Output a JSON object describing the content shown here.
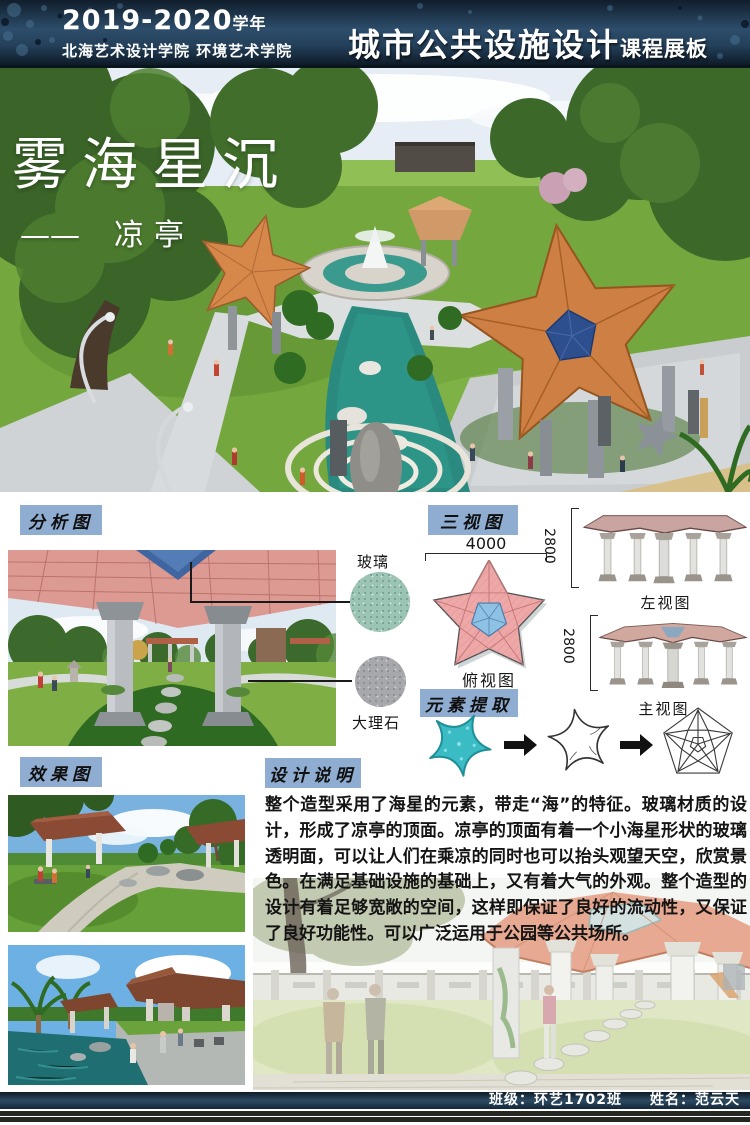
{
  "header": {
    "year": "2019-2020",
    "year_suffix": "学年",
    "school": "北海艺术设计学院 环境艺术学院",
    "title_main": "城市公共设施设计",
    "title_sub": "课程展板"
  },
  "hero": {
    "title": "雾海星沉",
    "dash": "——",
    "subtitle": "凉亭"
  },
  "labels": {
    "analysis": "分析图",
    "three_view": "三视图",
    "element_extract": "元素提取",
    "effect": "效果图",
    "description": "设计说明"
  },
  "materials": {
    "glass": "玻璃",
    "marble": "大理石"
  },
  "three_view": {
    "width_dim": "4000",
    "left_dim": "2800",
    "front_dim": "2800",
    "top_label": "俯视图",
    "left_label": "左视图",
    "front_label": "主视图"
  },
  "description_text": "整个造型采用了海星的元素，带走“海”的特征。玻璃材质的设计，形成了凉亭的顶面。凉亭的顶面有着一个小海星形状的玻璃透明面，可以让人们在乘凉的同时也可以抬头观望天空，欣赏景色。在满足基础设施的基础上，又有着大气的外观。整个造型的设计有着足够宽敞的空间，这样即保证了良好的流动性，又保证了良好功能性。可以广泛运用于公园等公共场所。",
  "footer": {
    "class_field": "班级：环艺1702班",
    "name_field": "姓名：范云天"
  },
  "accent_colors": {
    "header_navy": "#223c54",
    "label_blue": "#8fadd1",
    "star_pink": "#efa8a8",
    "glass_blue": "#8ec2e4",
    "starfish_teal": "#35b8c0",
    "roof_orange": "#cf8248"
  }
}
